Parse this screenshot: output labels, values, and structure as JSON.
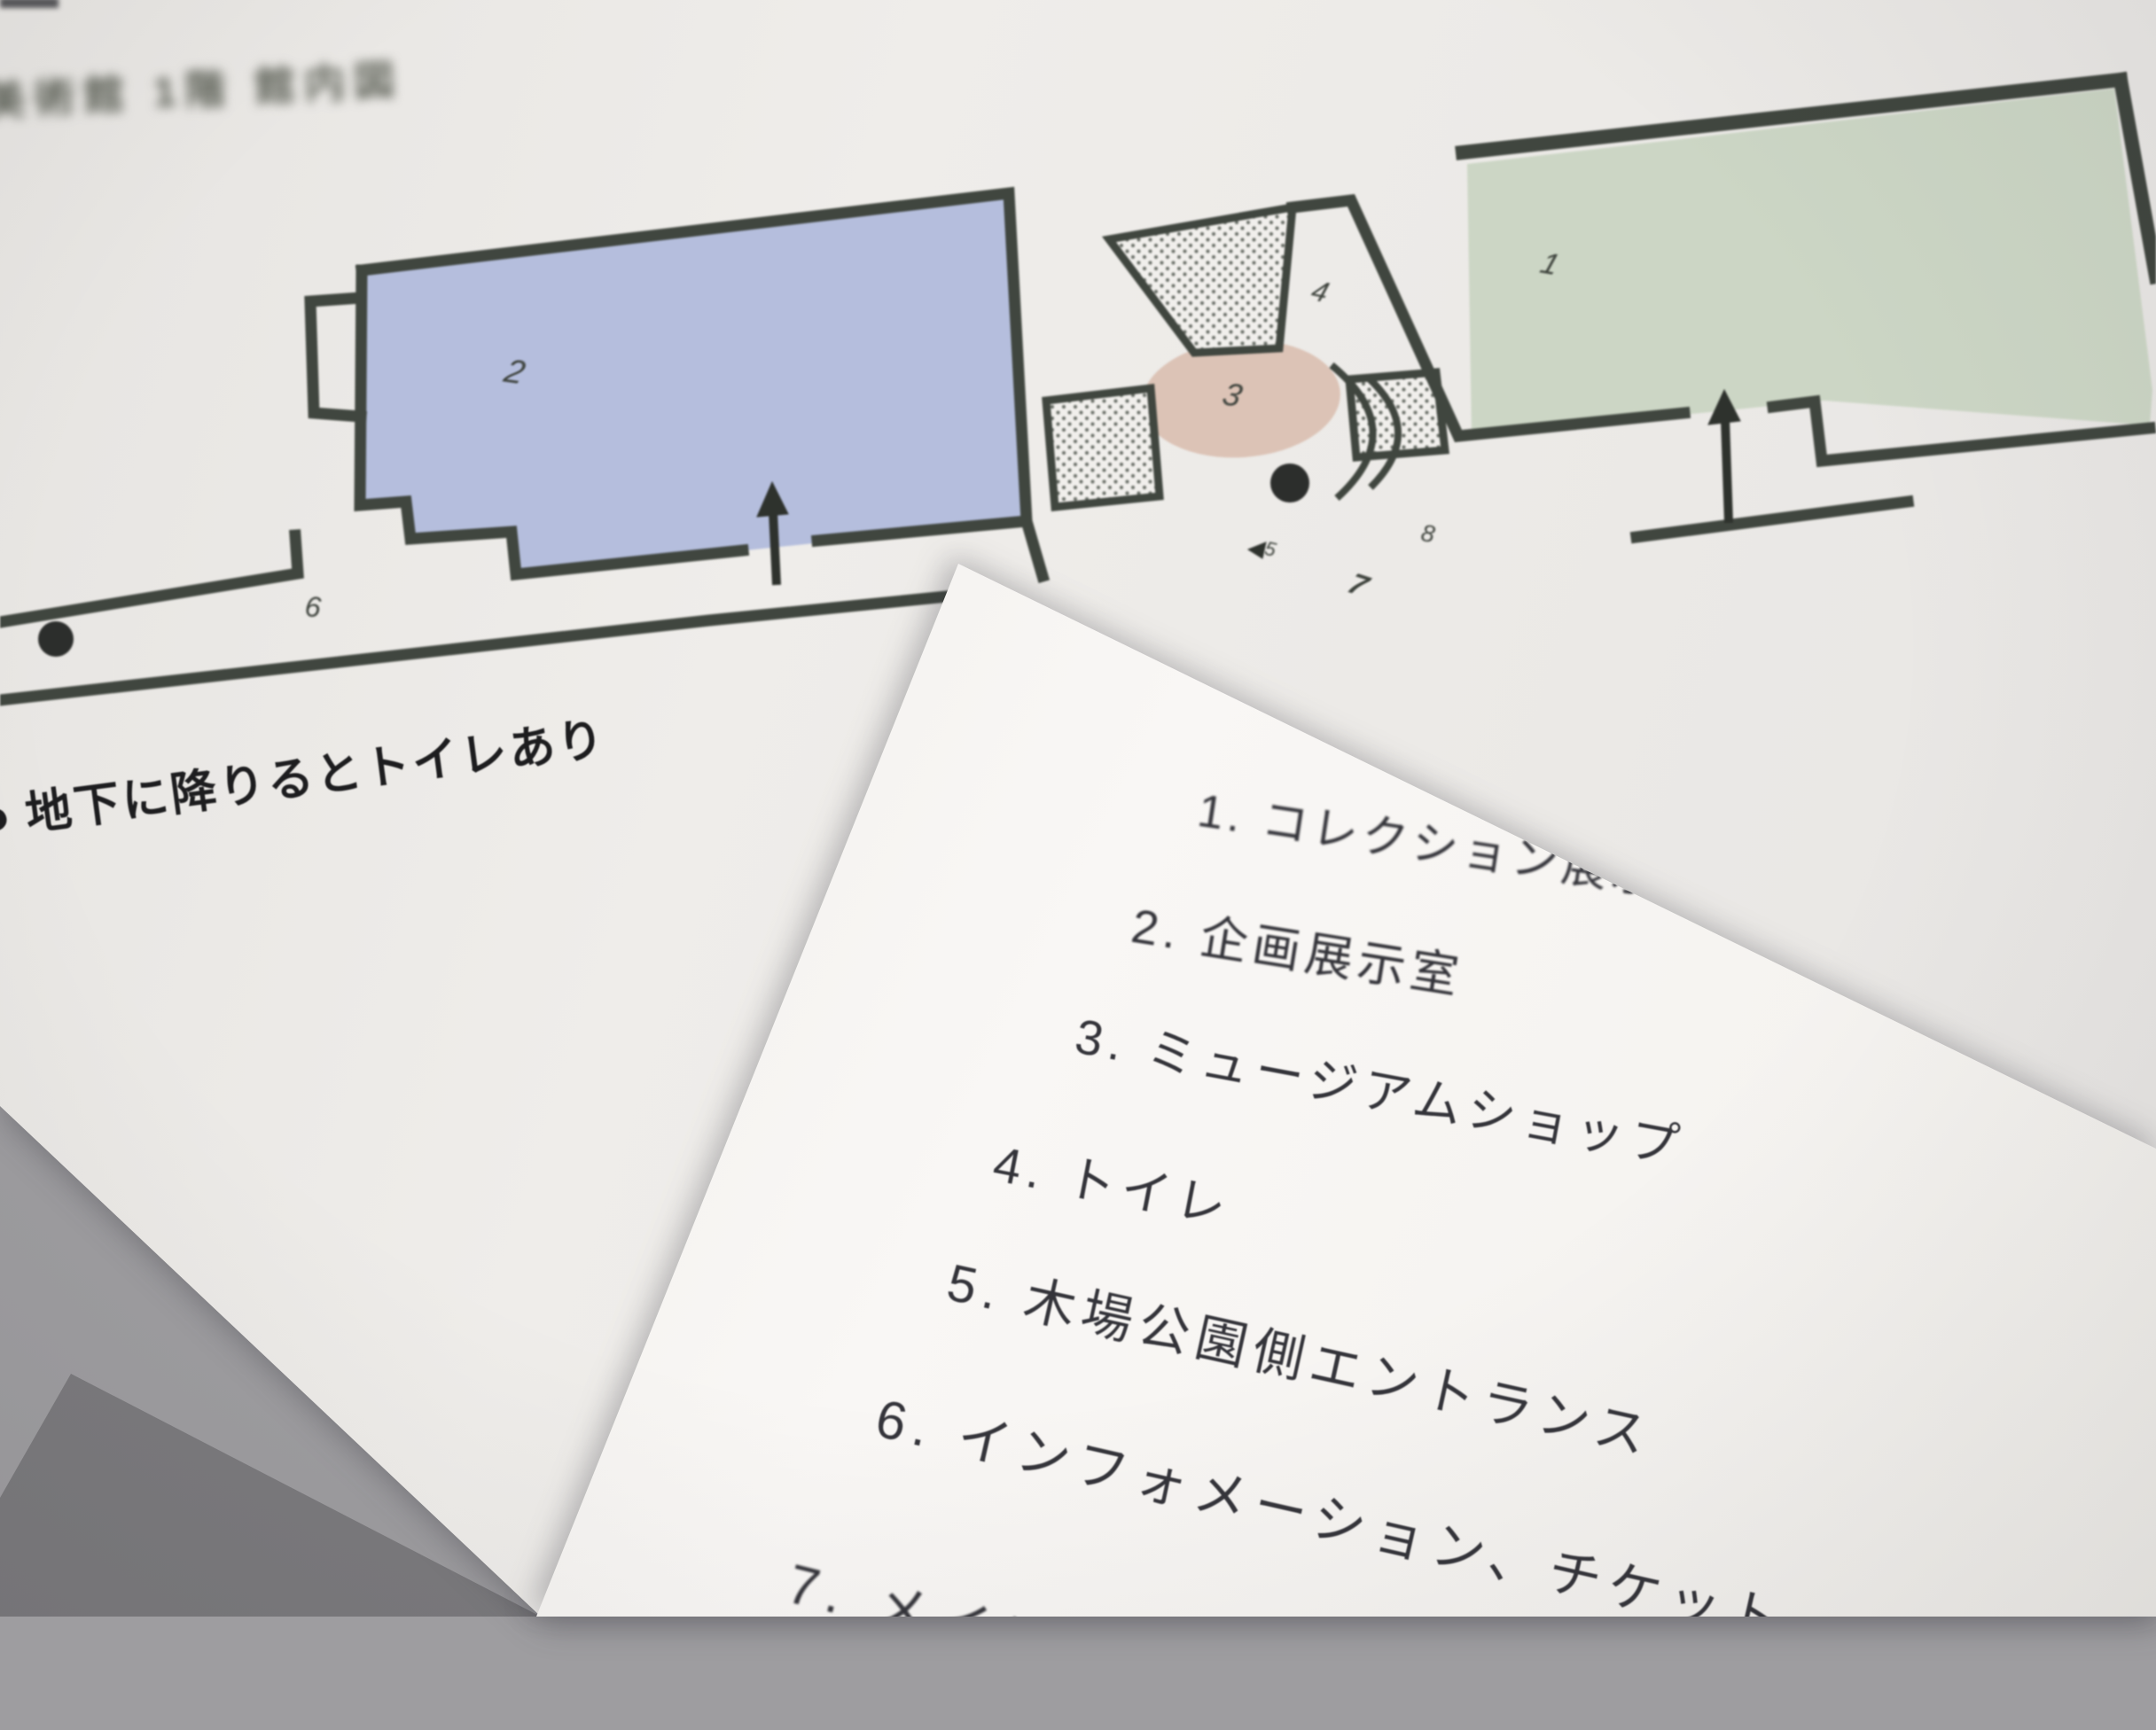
{
  "map_sheet": {
    "title": "美術館 1階 館内図",
    "note": {
      "bullet": "●",
      "text": "地下に降りるとトイレあり"
    },
    "room_numbers": [
      "1",
      "2",
      "3",
      "4",
      "5",
      "6",
      "7",
      "8"
    ]
  },
  "legend_sheet": {
    "items": [
      "1.  コレクション展示室",
      "2.  企画展示室",
      "3.  ミュージアムショップ",
      "4.  トイレ",
      "5.  木場公園側エントランス",
      "6.  インフォメーション、チケット",
      "7.  メインエント"
    ]
  },
  "colors": {
    "room1_green": "#ccd6c5",
    "room2_blue": "#b5bedd",
    "shop_circle_pink": "#dcc3b6",
    "wall_dark": "#40463f",
    "map_paper": "#edebe8",
    "legend_paper": "#f7f5f3",
    "table_gray": "#9e9da0",
    "table_dark_gray": "#7b7a7d"
  }
}
